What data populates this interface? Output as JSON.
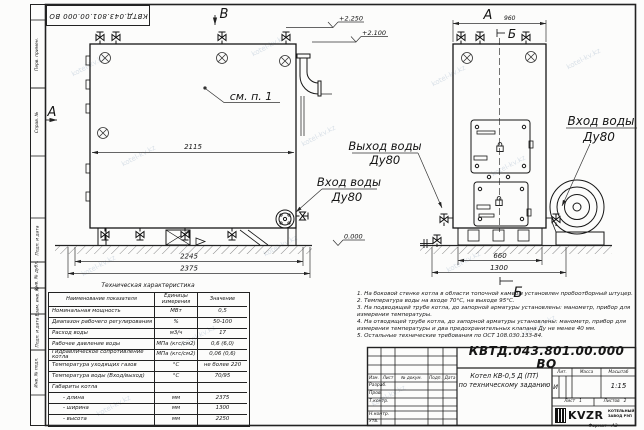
{
  "watermark": {
    "text": "kotel-kv.kz"
  },
  "border_labels": [
    "Перв. примен.",
    "Справ. №",
    "Подп. и дата",
    "Инв. № дубл.",
    "Взам. инв. №",
    "Подп. и дата",
    "Инв. № подл."
  ],
  "drawing": {
    "callout_1": "см. п. 1",
    "dim_front_width": "2115",
    "dim_front_frame": "2245",
    "dim_front_total": "2375",
    "dim_side_width": "960",
    "dim_side_base": "660",
    "dim_side_total": "1300",
    "elev_top": "+2.250",
    "elev_outlet": "+2.100",
    "elev_zero": "0.000",
    "view_a": "А",
    "view_b": "В",
    "view_b2": "Б",
    "label_outlet_1": "Выход воды",
    "label_outlet_2": "Ду80",
    "label_inlet_1": "Вход воды",
    "label_inlet_2": "Ду80",
    "label_inlet2_1": "Вход воды",
    "label_inlet2_2": "Ду80"
  },
  "spec_table": {
    "title": "Техническая характеристика",
    "headers": {
      "name": "Наименование показателя",
      "units": "Единицы измерения",
      "value": "Значение"
    },
    "rows": [
      {
        "name": "Номинальная мощность",
        "units": "МВт",
        "value": "0,5"
      },
      {
        "name": "Диапазон рабочего регулирования",
        "units": "%",
        "value": "50-100"
      },
      {
        "name": "Расход воды",
        "units": "м3/ч",
        "value": "17"
      },
      {
        "name": "Рабочее давление воды",
        "units": "МПа (кгс/см2)",
        "value": "0,6 (6,0)"
      },
      {
        "name": "Гидравлическое сопротивление котла",
        "units": "МПа (кгс/см2)",
        "value": "0,06 (0,6)"
      },
      {
        "name": "Температура уходящих газов",
        "units": "°С",
        "value": "не более 220"
      },
      {
        "name": "Температура воды (Вход/выход)",
        "units": "°С",
        "value": "70/95"
      },
      {
        "name": "Габариты котла",
        "units": "",
        "value": ""
      },
      {
        "name": "- длина",
        "units": "мм",
        "value": "2375"
      },
      {
        "name": "- ширина",
        "units": "мм",
        "value": "1300"
      },
      {
        "name": "- высота",
        "units": "мм",
        "value": "2250"
      }
    ]
  },
  "notes": [
    "1. На боковой стенке котла в области топочной камеры установлен пробоотборный штуцер.",
    "2. Температура воды на входе 70°С, на выходе 95°С.",
    "3. На подводящей трубе котла, до запорной арматуры установлены: манометр, прибор для измерения температуры.",
    "4. На отводящей трубе котла, до запорной арматуры установлены: манометр, прибор для измерения температуры и два предохранительных клапана Ду не менее 40 мм.",
    "5. Остальные технические требования по ОСТ 108.030.133-84."
  ],
  "title_block": {
    "doc_number": "КВТД.043.801.00.000  ВО",
    "title_line1": "Котел  КВ-0,5  Д  (ПТ)",
    "title_line2": "по техническому заданию",
    "col_izm": "Изм.",
    "col_list": "Лист",
    "col_doc": "№ докум.",
    "col_podp": "Подп.",
    "col_data": "Дата",
    "rows": [
      "Разраб.",
      "Пров.",
      "Т.контр.",
      "Н.контр.",
      "Утв."
    ],
    "lit_header": "Лит.",
    "lit_value": "И",
    "mass_header": "Масса",
    "scale_header": "Масштаб",
    "scale_value": "1:15",
    "sheet_label": "Лист",
    "sheet_value": "1",
    "sheets_label": "Листов",
    "sheets_value": "2",
    "logo_text": "KVZR",
    "company_line1": "КОТЕЛЬНЫЙ",
    "company_line2": "ЗАВОД РЭП",
    "format_label": "Формат",
    "format_value": "А3"
  }
}
